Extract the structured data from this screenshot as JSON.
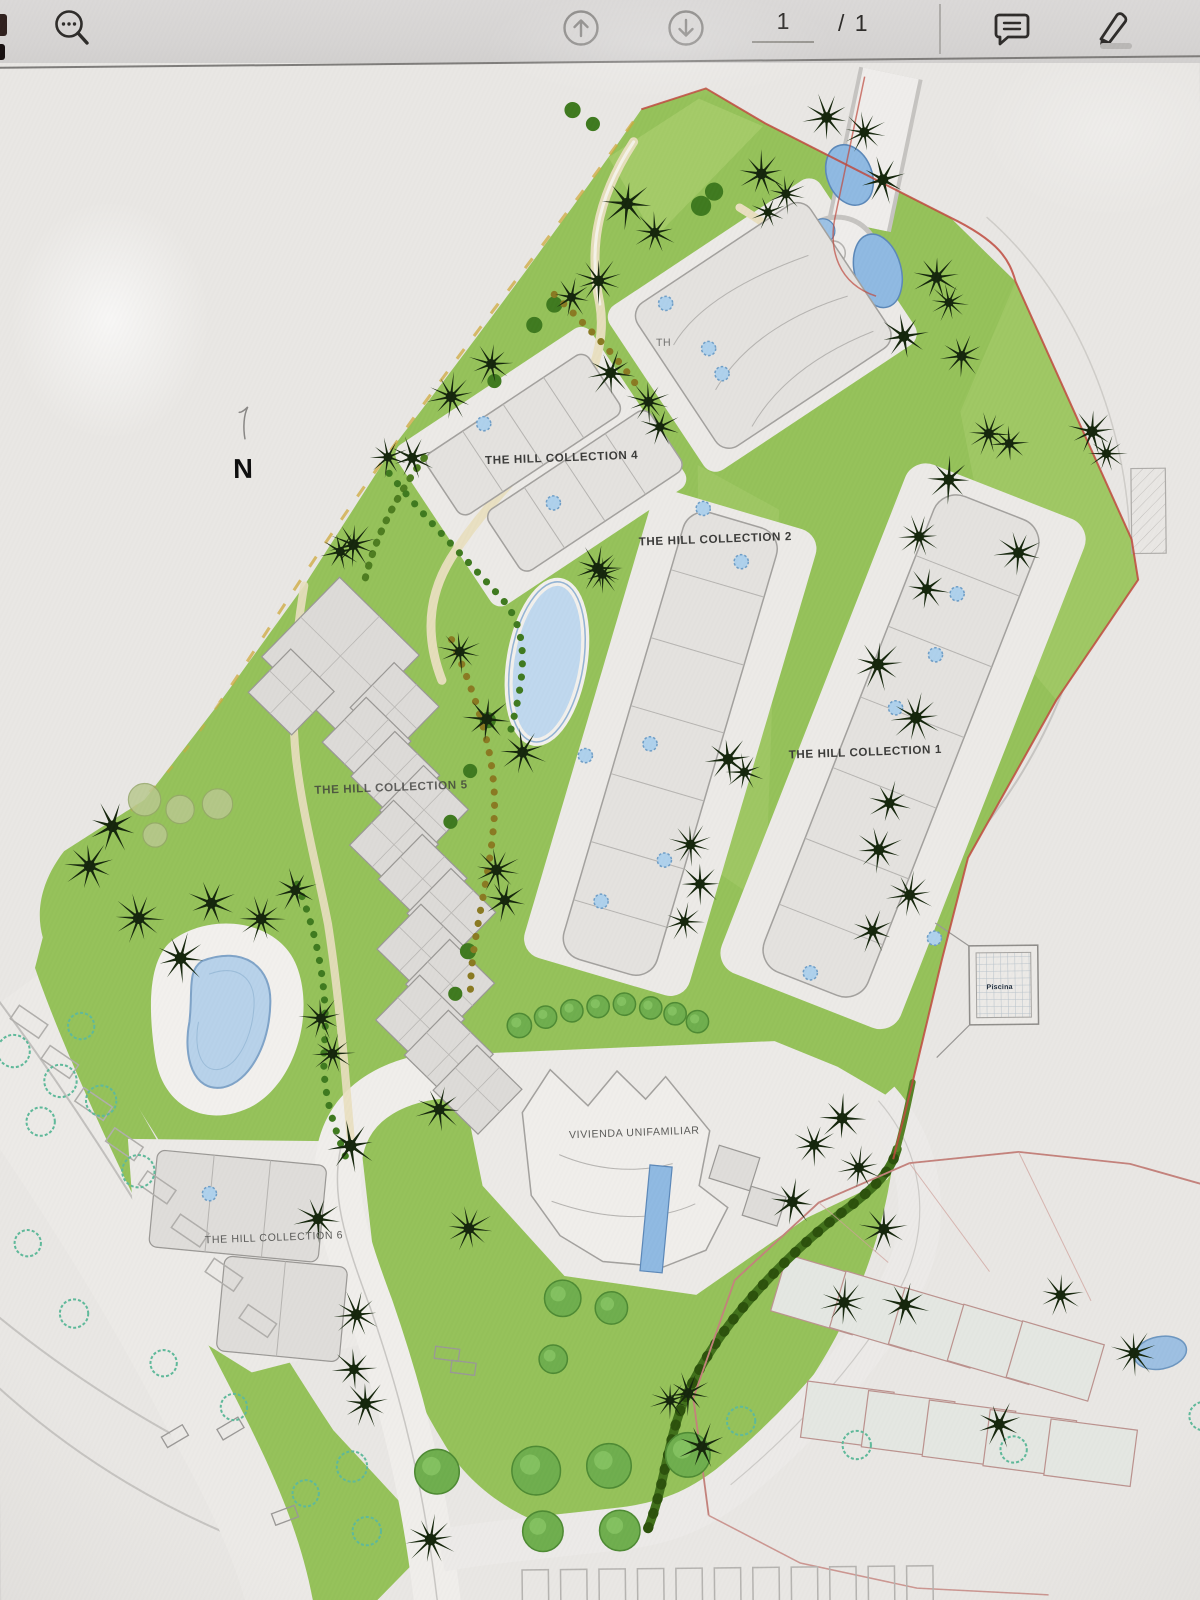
{
  "viewer_toolbar": {
    "search_icon": "magnifier-with-dots",
    "page_up_icon": "circled-up-arrow",
    "page_down_icon": "circled-down-arrow",
    "page_number": "1",
    "page_total": "/ 1",
    "comment_icon": "speech-bubble",
    "markup_icon": "marker-pen"
  },
  "site_plan": {
    "north_marker": "N",
    "labels": {
      "collection_4": "THE HILL COLLECTION 4",
      "collection_2": "THE HILL COLLECTION 2",
      "collection_1": "THE HILL COLLECTION 1",
      "collection_5": "THE HILL COLLECTION 5",
      "collection_6": "THE HILL COLLECTION 6",
      "collection_3_partial": "TH",
      "single_family_home": "VIVIENDA UNIFAMILIAR",
      "pool_area": "Piscina"
    },
    "colors": {
      "landscape_green": "#95c25a",
      "light_green": "#a9ce6e",
      "pool_blue": "#8fb9e2",
      "pond_blue": "#b7d2ea",
      "building_gray": "#e4e2df",
      "outline_gray": "#a3a19e",
      "boundary_red": "#bf4a3e",
      "palm_tree": "#15260c",
      "hedge_green": "#41701a",
      "paper": "#e9e7e4",
      "toolbar_bg": "#d7d5d4"
    }
  }
}
